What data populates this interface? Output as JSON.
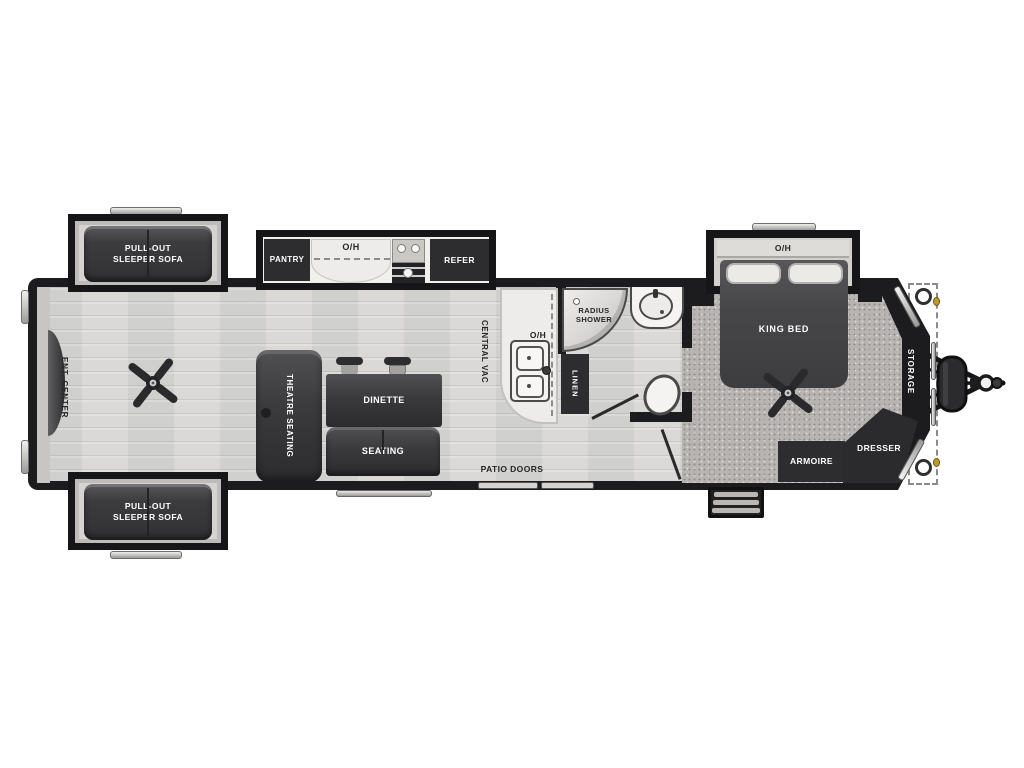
{
  "diagram": {
    "type": "rv-travel-trailer-floorplan",
    "labels": {
      "sofa": "PULL-OUT SLEEPER SOFA",
      "ent_center": "ENT. CENTER",
      "pantry": "PANTRY",
      "overhead": "O/H",
      "refer": "REFER",
      "central_vac": "CENTRAL VAC",
      "theatre": "THEATRE SEATING",
      "dinette": "DINETTE",
      "seating": "SEATING",
      "patio_doors": "PATIO DOORS",
      "radius_shower": "RADIUS SHOWER",
      "linen": "LINEN",
      "king_bed": "KING BED",
      "armoire": "ARMOIRE",
      "dresser": "DRESSER",
      "storage": "STORAGE"
    },
    "fixtures": [
      "ceiling-fan",
      "kitchen-sink",
      "stove",
      "refrigerator",
      "bathroom-vanity",
      "toilet",
      "radius-shower",
      "entry-steps",
      "trailer-hitch",
      "propane-tank",
      "stabilizer-jack",
      "patio-doors"
    ],
    "colors": {
      "wall": "#1c1c1e",
      "furniture": "#3a3a3c",
      "floor": "#d8d7d5",
      "carpet": "#b7b4b1",
      "counter": "#edecea",
      "background": "#ffffff",
      "accent_dot": "#c09a28"
    }
  }
}
